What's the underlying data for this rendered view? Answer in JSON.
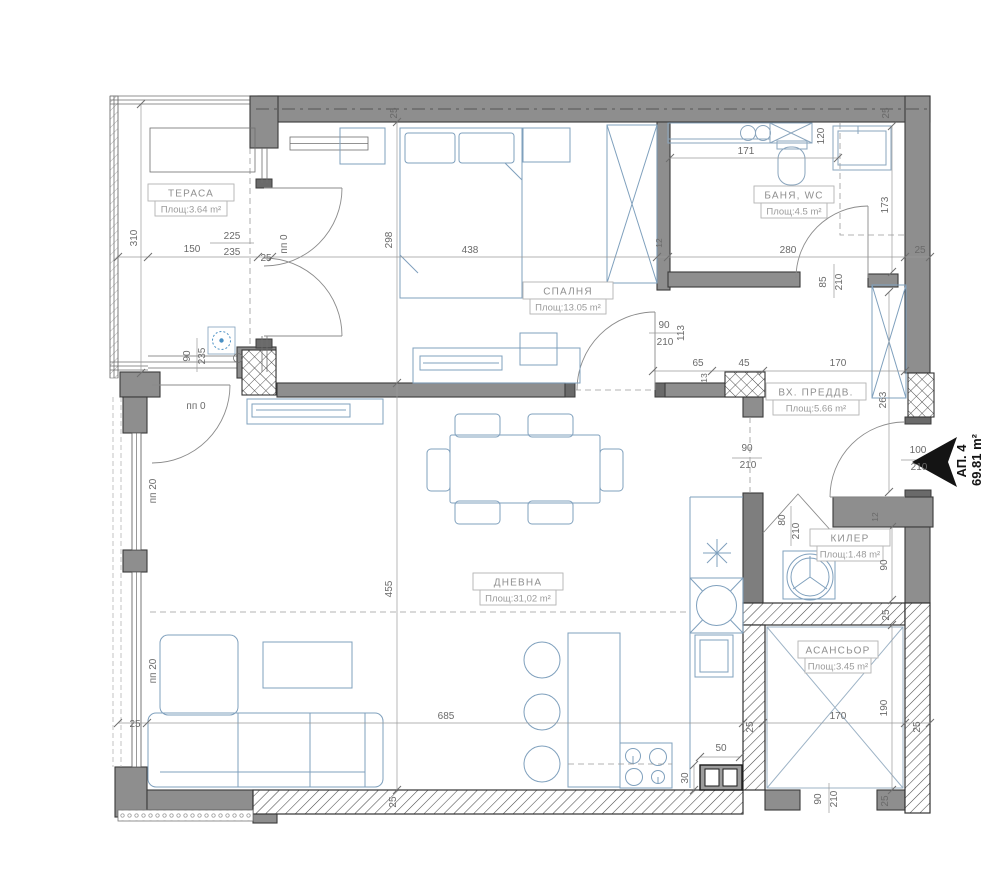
{
  "apartment": {
    "number": "АП. 4",
    "area": "69.81 m²"
  },
  "rooms": [
    {
      "id": "terrace",
      "name": "ТЕРАСА",
      "area": "Площ:3.64 m²",
      "cx": 191,
      "cy": 201,
      "w": 86
    },
    {
      "id": "bedroom",
      "name": "СПАЛНЯ",
      "area": "Площ:13.05 m²",
      "cx": 568,
      "cy": 299,
      "w": 90
    },
    {
      "id": "bathroom",
      "name": "БАНЯ, WC",
      "area": "Площ:4.5 m²",
      "cx": 794,
      "cy": 203,
      "w": 80
    },
    {
      "id": "entry",
      "name": "ВХ. ПРЕДДВ.",
      "area": "Площ:5.66 m²",
      "cx": 816,
      "cy": 400,
      "w": 100
    },
    {
      "id": "living",
      "name": "ДНЕВНА",
      "area": "Площ:31,02 m²",
      "cx": 518,
      "cy": 590,
      "w": 90
    },
    {
      "id": "closet",
      "name": "КИЛЕР",
      "area": "Площ:1.48 m²",
      "cx": 850,
      "cy": 546,
      "w": 80
    },
    {
      "id": "elevator",
      "name": "АСАНСЬОР",
      "area": "Площ:3.45 m²",
      "cx": 838,
      "cy": 658,
      "w": 80
    }
  ],
  "annotations": [
    {
      "t": "25",
      "x": 397,
      "y": 113,
      "r": -90
    },
    {
      "t": "25",
      "x": 889,
      "y": 113,
      "r": -90
    },
    {
      "t": "310",
      "x": 137,
      "y": 238,
      "r": -90
    },
    {
      "t": "150",
      "x": 192,
      "y": 252
    },
    {
      "t": "225",
      "x": 232,
      "y": 239
    },
    {
      "t": "235",
      "x": 232,
      "y": 255
    },
    {
      "t": "пп 0",
      "x": 287,
      "y": 244,
      "r": -90
    },
    {
      "t": "25",
      "x": 266,
      "y": 261
    },
    {
      "t": "298",
      "x": 392,
      "y": 240,
      "r": -90
    },
    {
      "t": "438",
      "x": 470,
      "y": 253
    },
    {
      "t": "280",
      "x": 788,
      "y": 253
    },
    {
      "t": "25",
      "x": 920,
      "y": 253
    },
    {
      "t": "171",
      "x": 746,
      "y": 154
    },
    {
      "t": "120",
      "x": 824,
      "y": 136,
      "r": -90
    },
    {
      "t": "173",
      "x": 888,
      "y": 205,
      "r": -90
    },
    {
      "t": "12",
      "x": 662,
      "y": 243,
      "r": -90,
      "cls": "sm"
    },
    {
      "t": "90",
      "x": 664,
      "y": 328
    },
    {
      "t": "210",
      "x": 665,
      "y": 345
    },
    {
      "t": "113",
      "x": 684,
      "y": 333,
      "r": -90
    },
    {
      "t": "90",
      "x": 190,
      "y": 356,
      "r": -90
    },
    {
      "t": "235",
      "x": 205,
      "y": 356,
      "r": -90
    },
    {
      "t": "пп 0",
      "x": 196,
      "y": 409
    },
    {
      "t": "65",
      "x": 698,
      "y": 366
    },
    {
      "t": "45",
      "x": 744,
      "y": 366
    },
    {
      "t": "170",
      "x": 838,
      "y": 366
    },
    {
      "t": "13",
      "x": 707,
      "y": 378,
      "r": -90,
      "cls": "sm"
    },
    {
      "t": "85",
      "x": 826,
      "y": 282,
      "r": -90
    },
    {
      "t": "210",
      "x": 842,
      "y": 282,
      "r": -90
    },
    {
      "t": "263",
      "x": 886,
      "y": 400,
      "r": -90
    },
    {
      "t": "90",
      "x": 747,
      "y": 451
    },
    {
      "t": "210",
      "x": 748,
      "y": 468
    },
    {
      "t": "100",
      "x": 918,
      "y": 453
    },
    {
      "t": "210",
      "x": 919,
      "y": 470
    },
    {
      "t": "пп 20",
      "x": 156,
      "y": 491,
      "r": -90
    },
    {
      "t": "пп 20",
      "x": 156,
      "y": 671,
      "r": -90
    },
    {
      "t": "80",
      "x": 785,
      "y": 520,
      "r": -90
    },
    {
      "t": "210",
      "x": 799,
      "y": 531,
      "r": -90
    },
    {
      "t": "12",
      "x": 878,
      "y": 517,
      "r": -90,
      "cls": "sm"
    },
    {
      "t": "90",
      "x": 887,
      "y": 565,
      "r": -90
    },
    {
      "t": "455",
      "x": 392,
      "y": 589,
      "r": -90
    },
    {
      "t": "25",
      "x": 889,
      "y": 615,
      "r": -90
    },
    {
      "t": "190",
      "x": 887,
      "y": 708,
      "r": -90
    },
    {
      "t": "685",
      "x": 446,
      "y": 719
    },
    {
      "t": "25",
      "x": 135,
      "y": 727
    },
    {
      "t": "170",
      "x": 838,
      "y": 719
    },
    {
      "t": "25",
      "x": 753,
      "y": 727,
      "r": -90
    },
    {
      "t": "25",
      "x": 920,
      "y": 727,
      "r": -90
    },
    {
      "t": "50",
      "x": 721,
      "y": 751
    },
    {
      "t": "30",
      "x": 688,
      "y": 778,
      "r": -90
    },
    {
      "t": "25",
      "x": 396,
      "y": 802,
      "r": -90
    },
    {
      "t": "90",
      "x": 821,
      "y": 799,
      "r": -90
    },
    {
      "t": "210",
      "x": 837,
      "y": 799,
      "r": -90
    },
    {
      "t": "25",
      "x": 888,
      "y": 801,
      "r": -90
    }
  ],
  "colors": {
    "wall": "#8e8e8e",
    "wall_dark": "#6a6a6a",
    "outline": "#3a3a3a",
    "furniture": "#7fa0bd",
    "dimension_text": "#6a6a6a",
    "room_label": "#8f8f8f",
    "entry_arrow": "#141414",
    "flower_symbol": "#4a90c4"
  }
}
